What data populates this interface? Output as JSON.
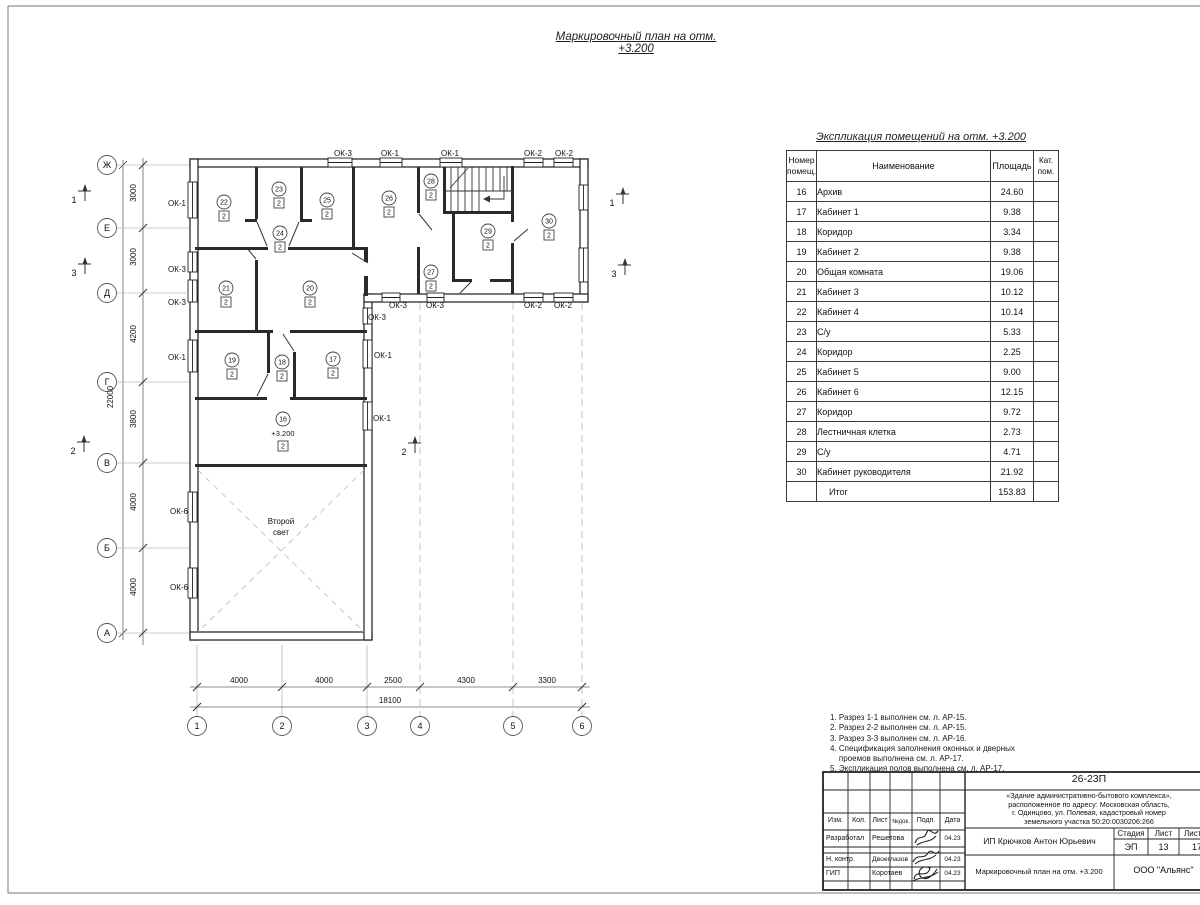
{
  "sheet": {
    "plan_title": "Маркировочный план на отм. +3.200"
  },
  "plan": {
    "second_light": [
      "Второй",
      "свет"
    ],
    "axes_rows": [
      {
        "label": "Ж",
        "y": 165
      },
      {
        "label": "Е",
        "y": 228
      },
      {
        "label": "Д",
        "y": 293
      },
      {
        "label": "Г",
        "y": 382
      },
      {
        "label": "В",
        "y": 463
      },
      {
        "label": "Б",
        "y": 548
      },
      {
        "label": "А",
        "y": 633
      }
    ],
    "axes_cols": [
      {
        "label": "1",
        "x": 197
      },
      {
        "label": "2",
        "x": 282
      },
      {
        "label": "3",
        "x": 367
      },
      {
        "label": "4",
        "x": 420
      },
      {
        "label": "5",
        "x": 513
      },
      {
        "label": "6",
        "x": 582
      }
    ],
    "row_dims": [
      {
        "text": "3000",
        "y": 196
      },
      {
        "text": "3000",
        "y": 260
      },
      {
        "text": "4200",
        "y": 337
      },
      {
        "text": "3800",
        "y": 422
      },
      {
        "text": "4000",
        "y": 505
      },
      {
        "text": "4000",
        "y": 590
      }
    ],
    "col_dims": [
      {
        "text": "4000",
        "x": 239
      },
      {
        "text": "4000",
        "x": 324
      },
      {
        "text": "2500",
        "x": 393
      },
      {
        "text": "4300",
        "x": 466
      },
      {
        "text": "3300",
        "x": 547
      }
    ],
    "total_height_dim": "22000",
    "total_width_dim": "18100",
    "rooms": [
      {
        "num": "22",
        "cat": "2",
        "x": 224,
        "y": 202
      },
      {
        "num": "23",
        "cat": "2",
        "x": 279,
        "y": 189
      },
      {
        "num": "24",
        "cat": "2",
        "x": 280,
        "y": 233
      },
      {
        "num": "25",
        "cat": "2",
        "x": 327,
        "y": 200
      },
      {
        "num": "26",
        "cat": "2",
        "x": 389,
        "y": 198
      },
      {
        "num": "28",
        "cat": "2",
        "x": 431,
        "y": 181
      },
      {
        "num": "29",
        "cat": "2",
        "x": 488,
        "y": 231
      },
      {
        "num": "30",
        "cat": "2",
        "x": 549,
        "y": 221
      },
      {
        "num": "27",
        "cat": "2",
        "x": 431,
        "y": 272
      },
      {
        "num": "21",
        "cat": "2",
        "x": 226,
        "y": 288
      },
      {
        "num": "20",
        "cat": "2",
        "x": 310,
        "y": 288
      },
      {
        "num": "19",
        "cat": "2",
        "x": 232,
        "y": 360
      },
      {
        "num": "18",
        "cat": "2",
        "x": 282,
        "y": 362
      },
      {
        "num": "17",
        "cat": "2",
        "x": 333,
        "y": 359
      },
      {
        "num": "16",
        "cat": "2",
        "x": 283,
        "y": 419,
        "level": "+3.200"
      }
    ],
    "windows": [
      {
        "text": "ОК-3",
        "x": 343,
        "y": 156
      },
      {
        "text": "ОК-1",
        "x": 390,
        "y": 156
      },
      {
        "text": "ОК-1",
        "x": 450,
        "y": 156
      },
      {
        "text": "ОК-2",
        "x": 533,
        "y": 156
      },
      {
        "text": "ОК-2",
        "x": 564,
        "y": 156
      },
      {
        "text": "ОК-1",
        "x": 177,
        "y": 206
      },
      {
        "text": "ОК-3",
        "x": 177,
        "y": 272
      },
      {
        "text": "ОК-3",
        "x": 177,
        "y": 305
      },
      {
        "text": "ОК-1",
        "x": 177,
        "y": 360
      },
      {
        "text": "ОК-6",
        "x": 179,
        "y": 514
      },
      {
        "text": "ОК-6",
        "x": 179,
        "y": 590
      },
      {
        "text": "ОК-3",
        "x": 398,
        "y": 308
      },
      {
        "text": "ОК-3",
        "x": 435,
        "y": 308
      },
      {
        "text": "ОК-3",
        "x": 377,
        "y": 320
      },
      {
        "text": "ОК-2",
        "x": 533,
        "y": 308
      },
      {
        "text": "ОК-2",
        "x": 563,
        "y": 308
      },
      {
        "text": "ОК-1",
        "x": 383,
        "y": 358
      },
      {
        "text": "ОК-1",
        "x": 382,
        "y": 421
      }
    ],
    "sections": [
      {
        "num": "1",
        "x": 74,
        "y": 200
      },
      {
        "num": "3",
        "x": 74,
        "y": 273
      },
      {
        "num": "2",
        "x": 73,
        "y": 451
      },
      {
        "num": "1",
        "x": 612,
        "y": 203
      },
      {
        "num": "3",
        "x": 614,
        "y": 274
      },
      {
        "num": "2",
        "x": 404,
        "y": 452
      }
    ]
  },
  "schedule": {
    "title": "Экспликация помещений на отм. +3.200",
    "headers": [
      "Номер\nпомещ.",
      "Наименование",
      "Площадь",
      "Кат.\nпом."
    ],
    "rows": [
      [
        "16",
        "Архив",
        "24.60"
      ],
      [
        "17",
        "Кабинет 1",
        "9.38"
      ],
      [
        "18",
        "Коридор",
        "3.34"
      ],
      [
        "19",
        "Кабинет 2",
        "9.38"
      ],
      [
        "20",
        "Общая комната",
        "19.06"
      ],
      [
        "21",
        "Кабинет 3",
        "10.12"
      ],
      [
        "22",
        "Кабинет 4",
        "10.14"
      ],
      [
        "23",
        "С/у",
        "5.33"
      ],
      [
        "24",
        "Коридор",
        "2.25"
      ],
      [
        "25",
        "Кабинет 5",
        "9.00"
      ],
      [
        "26",
        "Кабинет 6",
        "12.15"
      ],
      [
        "27",
        "Коридор",
        "9.72"
      ],
      [
        "28",
        "Лестничная клетка",
        "2.73"
      ],
      [
        "29",
        "С/у",
        "4.71"
      ],
      [
        "30",
        "Кабинет руководителя",
        "21.92"
      ]
    ],
    "total_label": "Итог",
    "total_value": "153.83"
  },
  "notes_lines": [
    "1. Разрез 1-1 выполнен см. л. АР-15.",
    "2. Разрез 2-2 выполнен см. л. АР-15.",
    "3. Разрез 3-3 выполнен см. л. АР-16.",
    "4. Спецификация заполнения оконных и дверных",
    "    проемов выполнена см. л. АР-17.",
    "5. Экспликация полов выполнена см. л. АР-17."
  ],
  "title_block": {
    "doc_code": "26-23П",
    "description": "«Здание административно-бытового комплекса»,\nрасположенное по адресу: Московская область,\nг. Одинцово, ул. Полевая, кадастровый номер\nземельного участка 50:20:0030206:266",
    "columns": [
      "Изм.",
      "Кол.",
      "Лист",
      "№док.",
      "Подп.",
      "Дата"
    ],
    "people": [
      {
        "role": "Разработал",
        "name": "Решетова",
        "date": "04.23"
      },
      {
        "role": "Н. контр.",
        "name": "Двоеглазов",
        "date": "04.23"
      },
      {
        "role": "ГИП",
        "name": "Коротаев",
        "date": "04.23"
      }
    ],
    "client": "ИП Крючков Антон Юрьевич",
    "stage_label": "Стадия",
    "sheet_label": "Лист",
    "sheets_label": "Листов",
    "stage": "ЭП",
    "sheet": "13",
    "sheets": "17",
    "drawing_name": "Маркировочный план на отм. +3.200",
    "company": "ООО \"Альянс\""
  }
}
